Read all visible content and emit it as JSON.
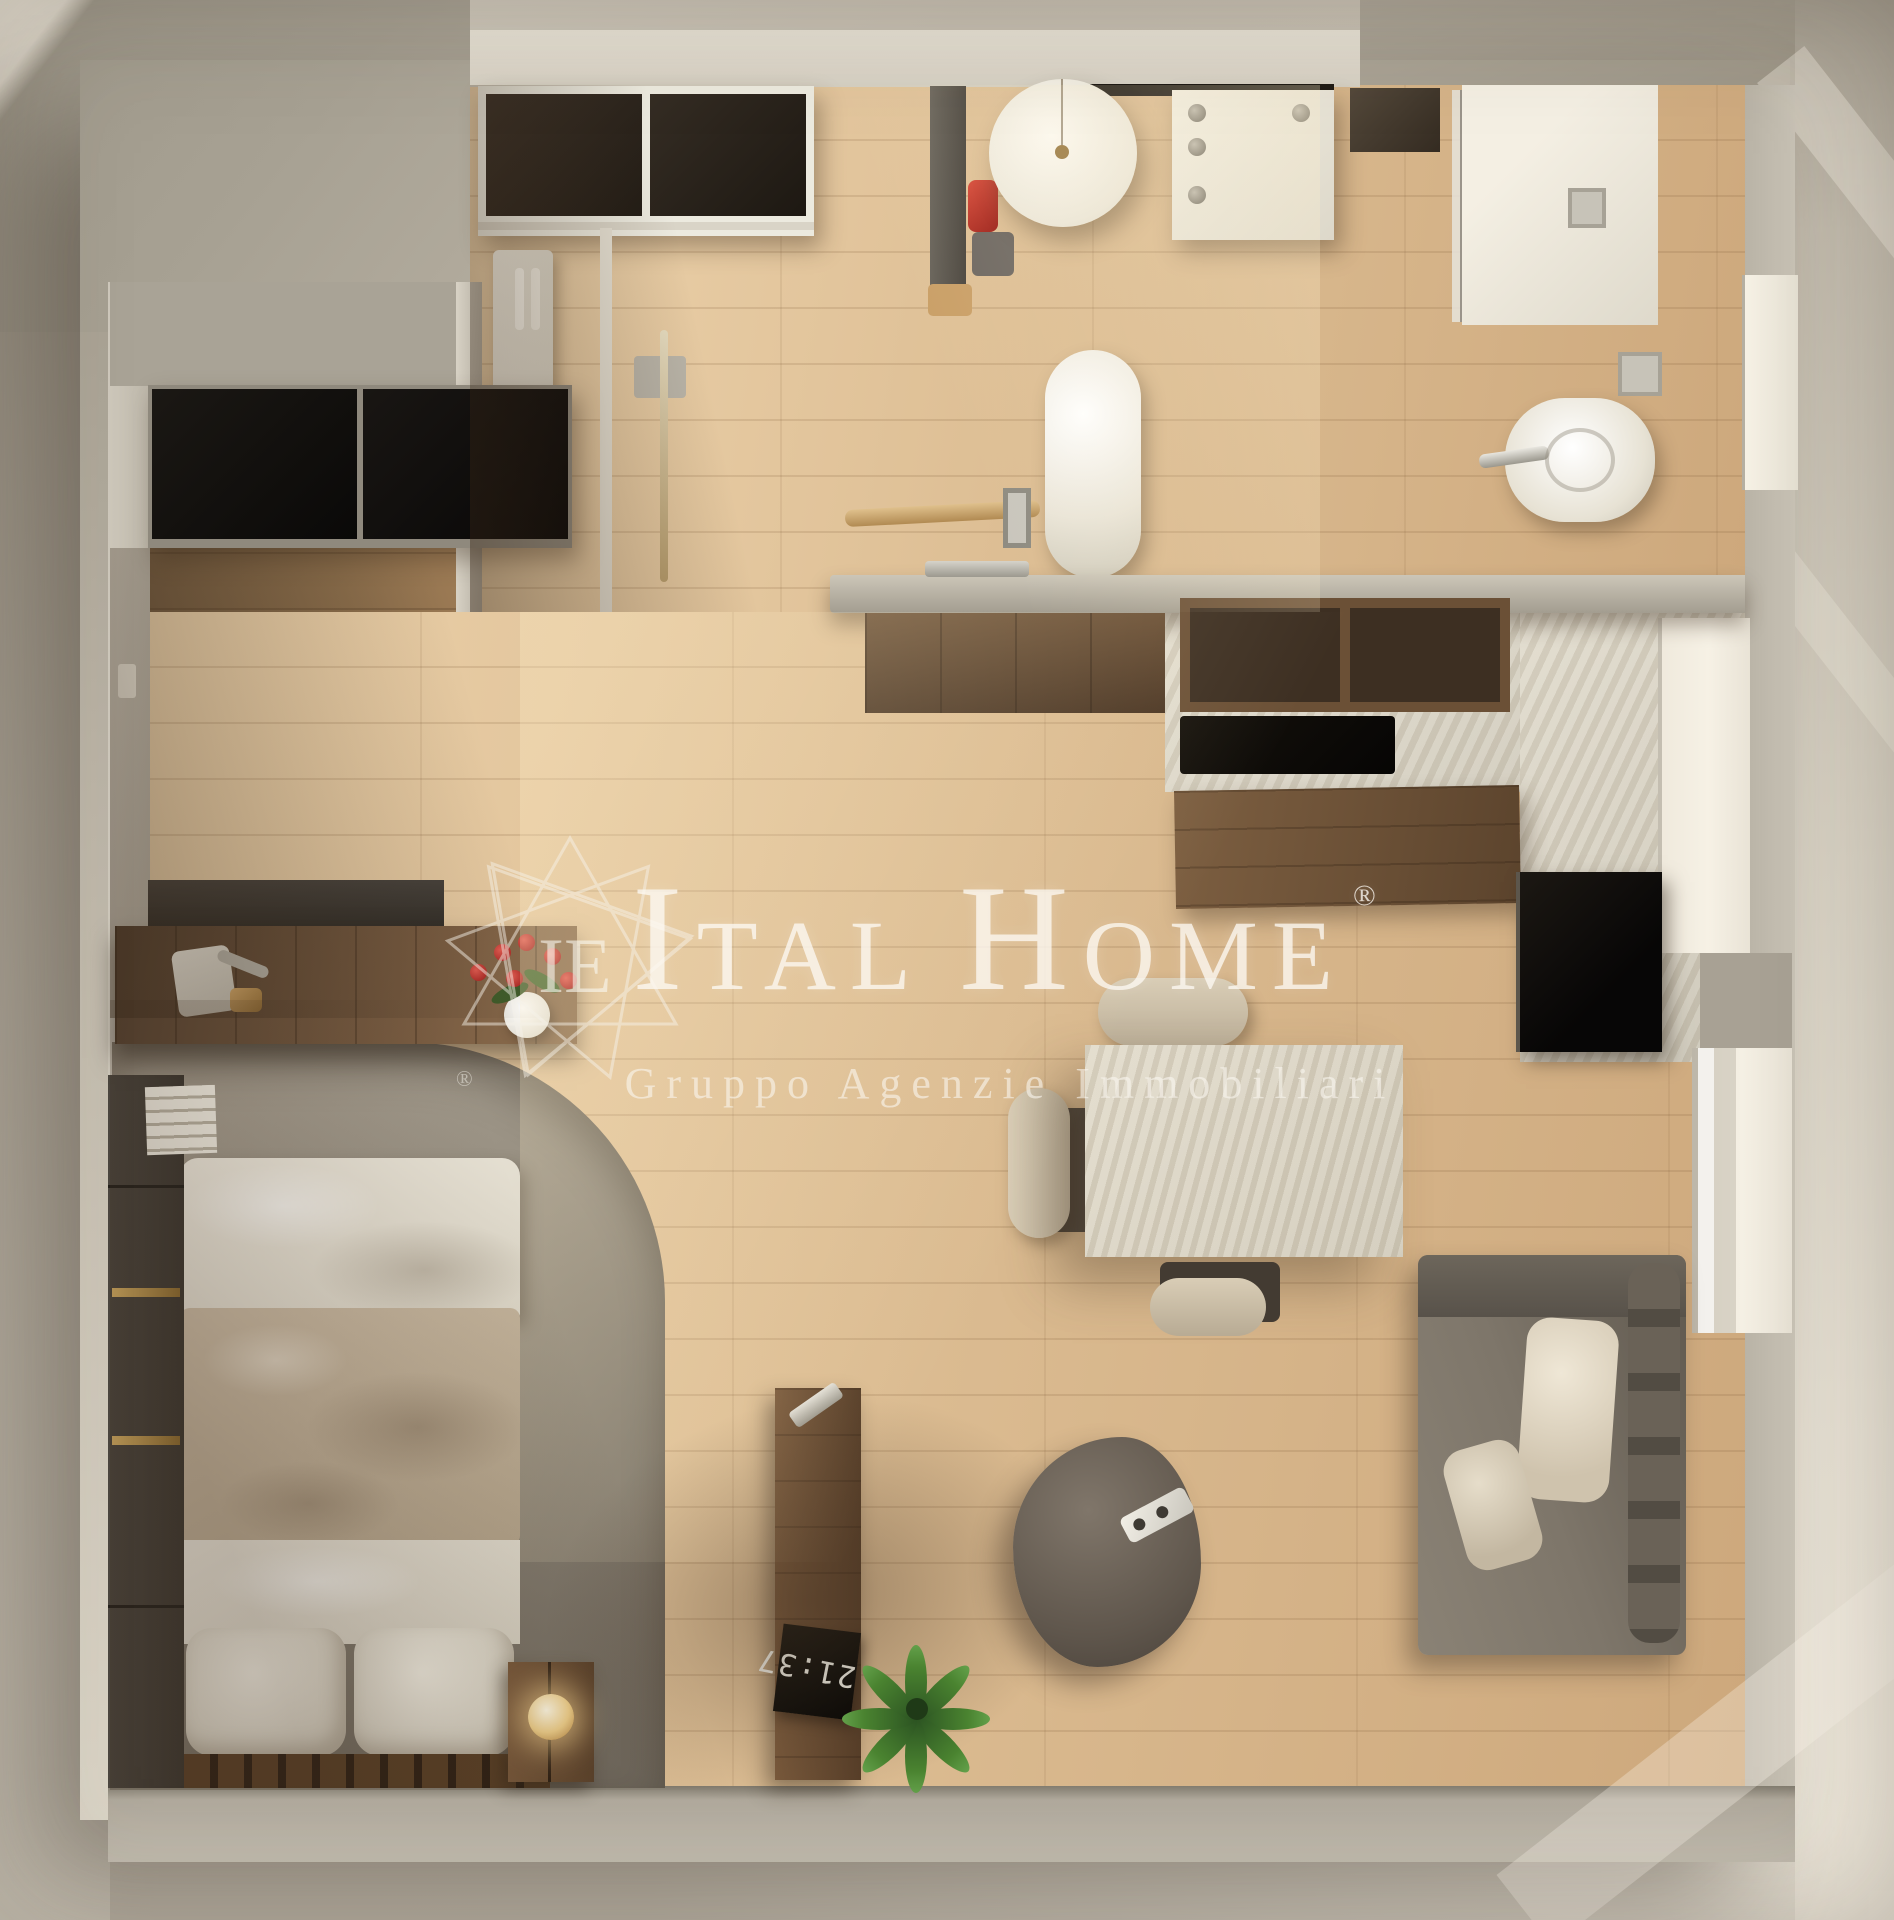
{
  "scene": {
    "description": "Top-down 3D render of a furnished studio apartment floor plan, bathed in diagonal sunlight",
    "width_px": 1894,
    "height_px": 1920
  },
  "watermark": {
    "monogram": "IE",
    "brand_i": "I",
    "brand_tal": "TAL",
    "brand_h": "H",
    "brand_ome": "OME",
    "registered": "®",
    "tagline": "Gruppo Agenzie Immobiliari"
  },
  "clock": {
    "display": "21:37"
  },
  "rooms": [
    "entry",
    "kitchen",
    "bathroom",
    "living-dining",
    "sleeping-area"
  ],
  "furniture": {
    "entry_wardrobe": "entry wardrobe with dark sliding doors",
    "coat_rack": "coat rack column",
    "pendant_lamp": "round white pendant lamp",
    "kitchen_unit": "white kitchen appliance unit with knobs",
    "fire_extinguisher": "red fire extinguisher",
    "shower": "walk-in shower with glass door",
    "toilet": "toilet",
    "bidet": "bidet with chrome faucet",
    "counter": "grey counter half-wall with towel bar",
    "base_cabinets": "walnut base cabinets",
    "wall_shelf": "walnut open wall shelf",
    "cooktop": "black cooktop",
    "tv": "wall-mounted black TV",
    "dining_table": "travertine dining table",
    "dining_chair": "beige upholstered dining chair",
    "sofa": "grey sofa with light cushions",
    "window": "bright window strip",
    "rug": "large grey area rug with rounded corner",
    "bed": "double bed with white linen and beige duvet",
    "pillow": "white pillow",
    "black_wardrobe": "black double wardrobe",
    "closet_strip": "wall closet with brass handles",
    "desk": "walnut desk with shelf",
    "desk_lamp": "white desk lamp and organizer",
    "flower_vase": "white vase with red flowers",
    "books": "stack of white magazines",
    "nightstand": "wood nightstand with glowing sphere lamp",
    "digital_clock": "black digital clock",
    "coffee_table": "pebble-shaped dark coffee table",
    "remote": "white remote control",
    "plant": "green potted plant"
  },
  "palette": {
    "background": "#cfc8bb",
    "wall": "#b3ac9e",
    "wood_floor": "#ddbe94",
    "dark_wood": "#6b5036",
    "travertine": "#d8d2c4",
    "rug_grey": "#8e8678",
    "blanket_beige": "#c2b29a",
    "linen_white": "#ece7db",
    "sofa_grey": "#776f64",
    "accent_red": "#c0272d",
    "plant_green": "#3e6e2e",
    "brass": "#c9a15a",
    "watermark_white": "#faf7f0"
  }
}
